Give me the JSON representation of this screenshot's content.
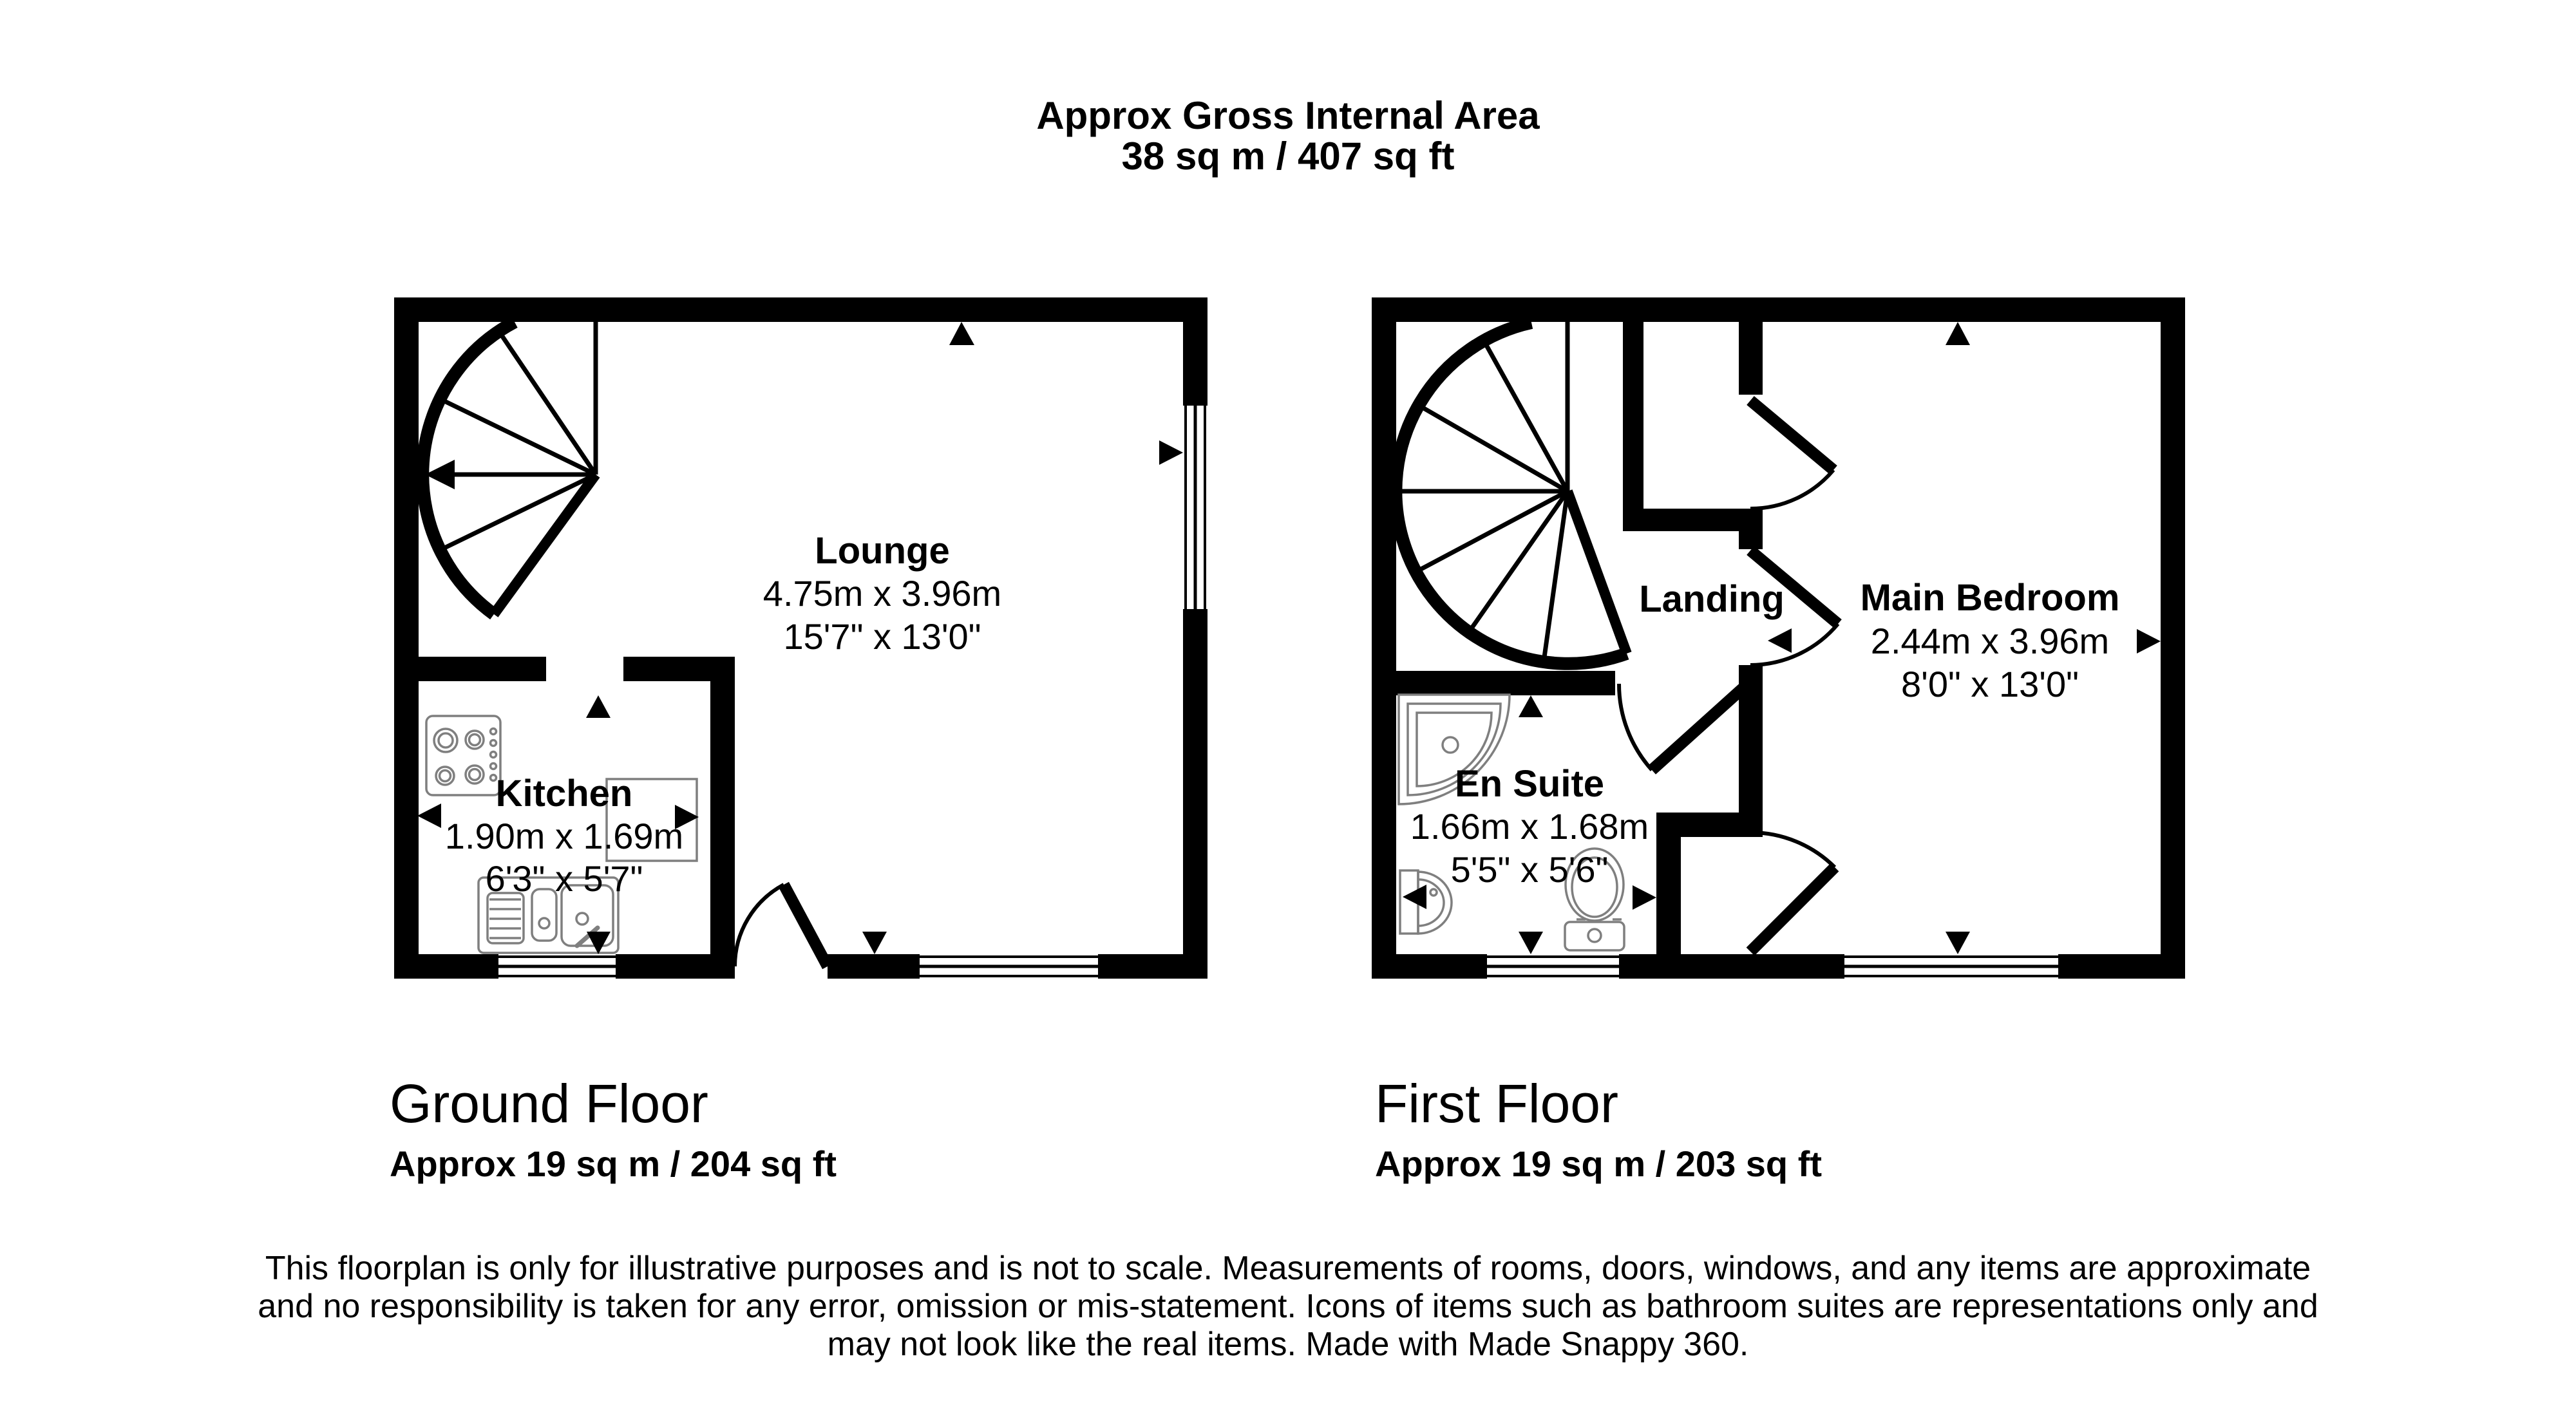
{
  "title": {
    "line1": "Approx Gross Internal Area",
    "line2": "38 sq m / 407 sq ft"
  },
  "ground_floor": {
    "label": "Ground Floor",
    "area": "Approx 19 sq m / 204 sq ft",
    "rooms": [
      {
        "name": "Lounge",
        "metric": "4.75m x 3.96m",
        "imperial": "15'7\" x 13'0\""
      },
      {
        "name": "Kitchen",
        "metric": "1.90m x 1.69m",
        "imperial": "6'3\" x 5'7\""
      }
    ]
  },
  "first_floor": {
    "label": "First Floor",
    "area": "Approx 19 sq m / 203 sq ft",
    "rooms": [
      {
        "name": "Landing"
      },
      {
        "name": "Main Bedroom",
        "metric": "2.44m x 3.96m",
        "imperial": "8'0\" x 13'0\""
      },
      {
        "name": "En Suite",
        "metric": "1.66m x 1.68m",
        "imperial": "5'5\" x 5'6\""
      }
    ]
  },
  "disclaimer": {
    "line1": "This floorplan is only for illustrative purposes and is not to scale. Measurements of rooms, doors, windows, and any items are approximate",
    "line2": "and no responsibility is taken for any error, omission or mis-statement. Icons of items such as bathroom suites are representations only and",
    "line3": "may not look like the real items. Made with Made Snappy 360."
  },
  "icons": {
    "stairs": "spiral-staircase",
    "kitchen": [
      "hob",
      "sink-drainer",
      "worktop"
    ],
    "en_suite": [
      "corner-shower",
      "pedestal-basin",
      "toilet"
    ],
    "markers": "measurement-triangles"
  },
  "colors": {
    "walls": "#000000",
    "fixtures": "#7f7f7f",
    "background": "#ffffff",
    "text": "#000000"
  }
}
